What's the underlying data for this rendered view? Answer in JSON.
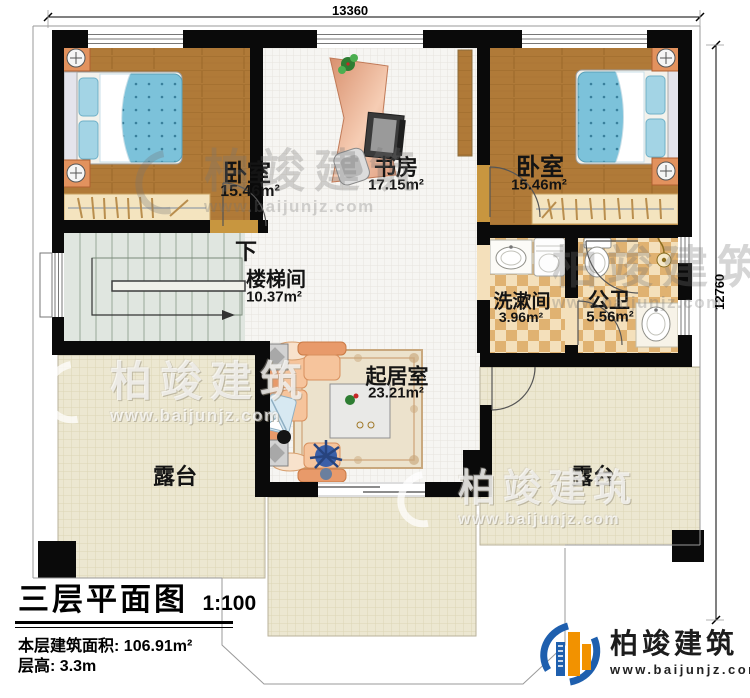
{
  "dimensions": {
    "top": "13360",
    "right": "12760"
  },
  "rooms": {
    "bedroom_left": {
      "name": "卧室",
      "area": "15.46m²"
    },
    "study": {
      "name": "书房",
      "area": "17.15m²"
    },
    "bedroom_right": {
      "name": "卧室",
      "area": "15.46m²"
    },
    "stairwell": {
      "name": "楼梯间",
      "area": "10.37m²",
      "stair_direction": "下"
    },
    "washroom": {
      "name": "洗漱间",
      "area": "3.96m²"
    },
    "bathroom": {
      "name": "公卫",
      "area": "5.56m²"
    },
    "living_room": {
      "name": "起居室",
      "area": "23.21m²"
    },
    "terrace_left": {
      "name": "露台"
    },
    "terrace_right": {
      "name": "露台"
    }
  },
  "title_block": {
    "title": "三层平面图",
    "scale": "1:100",
    "floor_area_label": "本层建筑面积:",
    "floor_area_value": "106.91m²",
    "floor_height_label": "层高:",
    "floor_height_value": "3.3m"
  },
  "brand": {
    "name": "柏竣建筑",
    "website": "www.baijunjz.com"
  },
  "watermark": {
    "text": "柏竣建筑",
    "website": "www.baijunjz.com"
  },
  "colors": {
    "wall": "#0a0a0a",
    "wood_floor": "#b07a38",
    "tile_floor": "#f6f5f2",
    "terrace_floor": "#ece7d1",
    "bath_tile": "#e0b271",
    "stair_floor": "#e0e6e0",
    "bed_blue": "#7cc2da",
    "furniture_peach": "#f0b183",
    "brand_blue": "#1e5fae",
    "brand_orange": "#f29200"
  }
}
